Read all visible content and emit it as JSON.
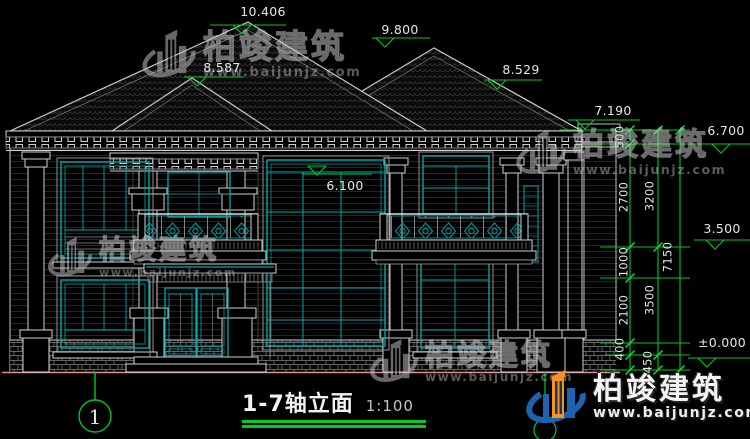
{
  "title_block": {
    "title": "1-7轴立面",
    "scale": "1:100"
  },
  "axis_markers": {
    "start": "1"
  },
  "elevations": {
    "roof_peak_main": "10.406",
    "roof_peak_right": "9.800",
    "porch_peak": "8.587",
    "roof_slope_right": "8.529",
    "rear_eave_high": "7.190",
    "rear_eave_low": "6.700",
    "window_head": "6.100",
    "second_floor": "3.500",
    "ground_floor": "±0.000"
  },
  "dimension_chains": {
    "inner": [
      "500",
      "2700",
      "1000",
      "2100",
      "400"
    ],
    "mid": [
      "3200",
      "3500",
      "450"
    ],
    "overall": "7150"
  },
  "watermark": {
    "brand": "柏竣建筑",
    "url": "www.baijunjz.com"
  },
  "colors": {
    "dimension_green": "#00c822",
    "window_teal": "#00a9a9",
    "drawing_white": "#d0d0d0",
    "ground_line_pink": "#d98c8c",
    "logo_blue": "#1e63b0",
    "logo_orange": "#f7941d"
  }
}
